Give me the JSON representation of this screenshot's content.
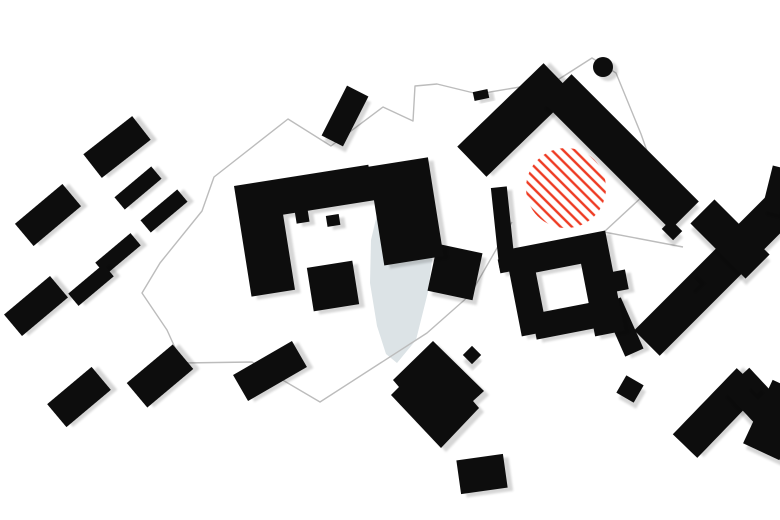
{
  "canvas": {
    "width": 780,
    "height": 520,
    "background": "#ffffff"
  },
  "palette": {
    "building": "#0a0a0a",
    "shadow_opacity": 0.16,
    "boundary": "#bcbcbc",
    "water": "#dce3e6",
    "hatch_red": "#ee3a22"
  },
  "water_body": {
    "name": "pond",
    "path": "M393,183 L426,194 L435,237 L428,292 L416,340 L397,363 L386,354 L377,326 L370,283 L371,240 L379,206 Z"
  },
  "site_boundary": {
    "name": "site-boundary-line",
    "stroke_width": 1.4,
    "path": "M512,222 L470,295 L427,333 L320,402 L252,362 L182,363 L167,330 L142,293 L160,263 L202,211 L214,177 L288,119 L331,146 L383,107 L413,121 L415,86 L437,84 L478,94 L556,81 L592,58 L616,73 L641,134 L658,182 L604,232 L683,247"
  },
  "hatch_area": {
    "name": "red-hatched-intervention-area",
    "cx": 566,
    "cy": 188,
    "r": 40,
    "angle_deg": 45,
    "spacing": 8,
    "stroke_width": 2.4
  },
  "landmark_circle": {
    "name": "round-tower",
    "cx": 603,
    "cy": 67,
    "r": 10
  },
  "buildings": {
    "rects": [
      {
        "name": "house-a",
        "cx": 117,
        "cy": 147,
        "w": 62,
        "h": 30,
        "rot": -38
      },
      {
        "name": "house-b",
        "cx": 138,
        "cy": 188,
        "w": 48,
        "h": 16,
        "rot": -40
      },
      {
        "name": "house-c",
        "cx": 164,
        "cy": 211,
        "w": 48,
        "h": 16,
        "rot": -40
      },
      {
        "name": "house-d",
        "cx": 48,
        "cy": 215,
        "w": 62,
        "h": 29,
        "rot": -40
      },
      {
        "name": "house-e",
        "cx": 118,
        "cy": 254,
        "w": 46,
        "h": 16,
        "rot": -40
      },
      {
        "name": "house-f",
        "cx": 91,
        "cy": 285,
        "w": 46,
        "h": 16,
        "rot": -40
      },
      {
        "name": "house-g",
        "cx": 36,
        "cy": 306,
        "w": 60,
        "h": 28,
        "rot": -40
      },
      {
        "name": "house-h",
        "cx": 79,
        "cy": 397,
        "w": 58,
        "h": 30,
        "rot": -40
      },
      {
        "name": "house-i",
        "cx": 160,
        "cy": 376,
        "w": 60,
        "h": 32,
        "rot": -40
      },
      {
        "name": "house-j",
        "cx": 270,
        "cy": 371,
        "w": 68,
        "h": 30,
        "rot": -30
      },
      {
        "name": "north-bar",
        "cx": 345,
        "cy": 116,
        "w": 24,
        "h": 56,
        "rot": 27
      },
      {
        "name": "boundary-hut",
        "cx": 481,
        "cy": 95,
        "w": 15,
        "h": 9,
        "rot": -12
      },
      {
        "name": "square-west-block",
        "cx": 455,
        "cy": 272,
        "w": 46,
        "h": 48,
        "rot": 12
      },
      {
        "name": "chevron-left-arm",
        "cx": 515,
        "cy": 120,
        "w": 120,
        "h": 42,
        "rot": -44
      },
      {
        "name": "chevron-right-arm",
        "cx": 621,
        "cy": 152,
        "w": 180,
        "h": 40,
        "rot": 45
      },
      {
        "name": "chevron-stub",
        "cx": 503,
        "cy": 227,
        "w": 16,
        "h": 80,
        "rot": -6
      },
      {
        "name": "chevron-arm-tooth",
        "cx": 672,
        "cy": 230,
        "w": 16,
        "h": 13,
        "rot": 45
      },
      {
        "name": "central-annex",
        "cx": 333,
        "cy": 286,
        "w": 46,
        "h": 44,
        "rot": -9
      },
      {
        "name": "courtyard-extension",
        "cx": 623,
        "cy": 327,
        "w": 20,
        "h": 56,
        "rot": -24
      },
      {
        "name": "small-diamond-dot",
        "cx": 472,
        "cy": 355,
        "w": 13,
        "h": 13,
        "rot": 45
      },
      {
        "name": "east-diamond-dot",
        "cx": 630,
        "cy": 389,
        "w": 20,
        "h": 20,
        "rot": 30
      },
      {
        "name": "south-rect",
        "cx": 482,
        "cy": 474,
        "w": 47,
        "h": 34,
        "rot": -8
      },
      {
        "name": "east-bar-long",
        "cx": 695,
        "cy": 295,
        "w": 136,
        "h": 36,
        "rot": -45
      },
      {
        "name": "east-bar-tooth",
        "cx": 690,
        "cy": 285,
        "w": 15,
        "h": 13,
        "rot": -45
      },
      {
        "name": "east-bar-upper",
        "cx": 759,
        "cy": 229,
        "w": 66,
        "h": 36,
        "rot": -45
      },
      {
        "name": "east-cross-bar",
        "cx": 730,
        "cy": 239,
        "w": 78,
        "h": 34,
        "rot": 45
      },
      {
        "name": "east-edge-bar",
        "cx": 776,
        "cy": 190,
        "w": 18,
        "h": 46,
        "rot": 14
      },
      {
        "name": "zigzag-arm-west",
        "cx": 717,
        "cy": 413,
        "w": 92,
        "h": 34,
        "rot": -46
      },
      {
        "name": "zigzag-arm-mid",
        "cx": 758,
        "cy": 402,
        "w": 62,
        "h": 34,
        "rot": 47
      },
      {
        "name": "zigzag-arm-east",
        "cx": 776,
        "cy": 420,
        "w": 40,
        "h": 70,
        "rot": 25
      },
      {
        "name": "zigzag-tooth",
        "cx": 756,
        "cy": 386,
        "w": 13,
        "h": 10,
        "rot": 45
      }
    ],
    "groups": [
      {
        "name": "central-u-complex",
        "tx": 234,
        "ty": 186,
        "rot": -9,
        "rects": [
          [
            0,
            0,
            44,
            112
          ],
          [
            44,
            0,
            92,
            36
          ],
          [
            56,
            36,
            13,
            11
          ],
          [
            86,
            44,
            13,
            11
          ],
          [
            136,
            2,
            60,
            100
          ]
        ]
      },
      {
        "name": "courtyard-complex",
        "tx": 505,
        "ty": 250,
        "rot": -11,
        "rects": [
          [
            0,
            0,
            100,
            28
          ],
          [
            0,
            0,
            26,
            88
          ],
          [
            14,
            68,
            76,
            26
          ],
          [
            72,
            0,
            30,
            102
          ],
          [
            102,
            42,
            12,
            20
          ],
          [
            -9,
            8,
            10,
            14
          ]
        ]
      }
    ],
    "polygons": [
      {
        "name": "diamond-block",
        "points": "433,341 484,391 473,401 479,408 441,448 391,395 399,387 393,380"
      }
    ]
  }
}
